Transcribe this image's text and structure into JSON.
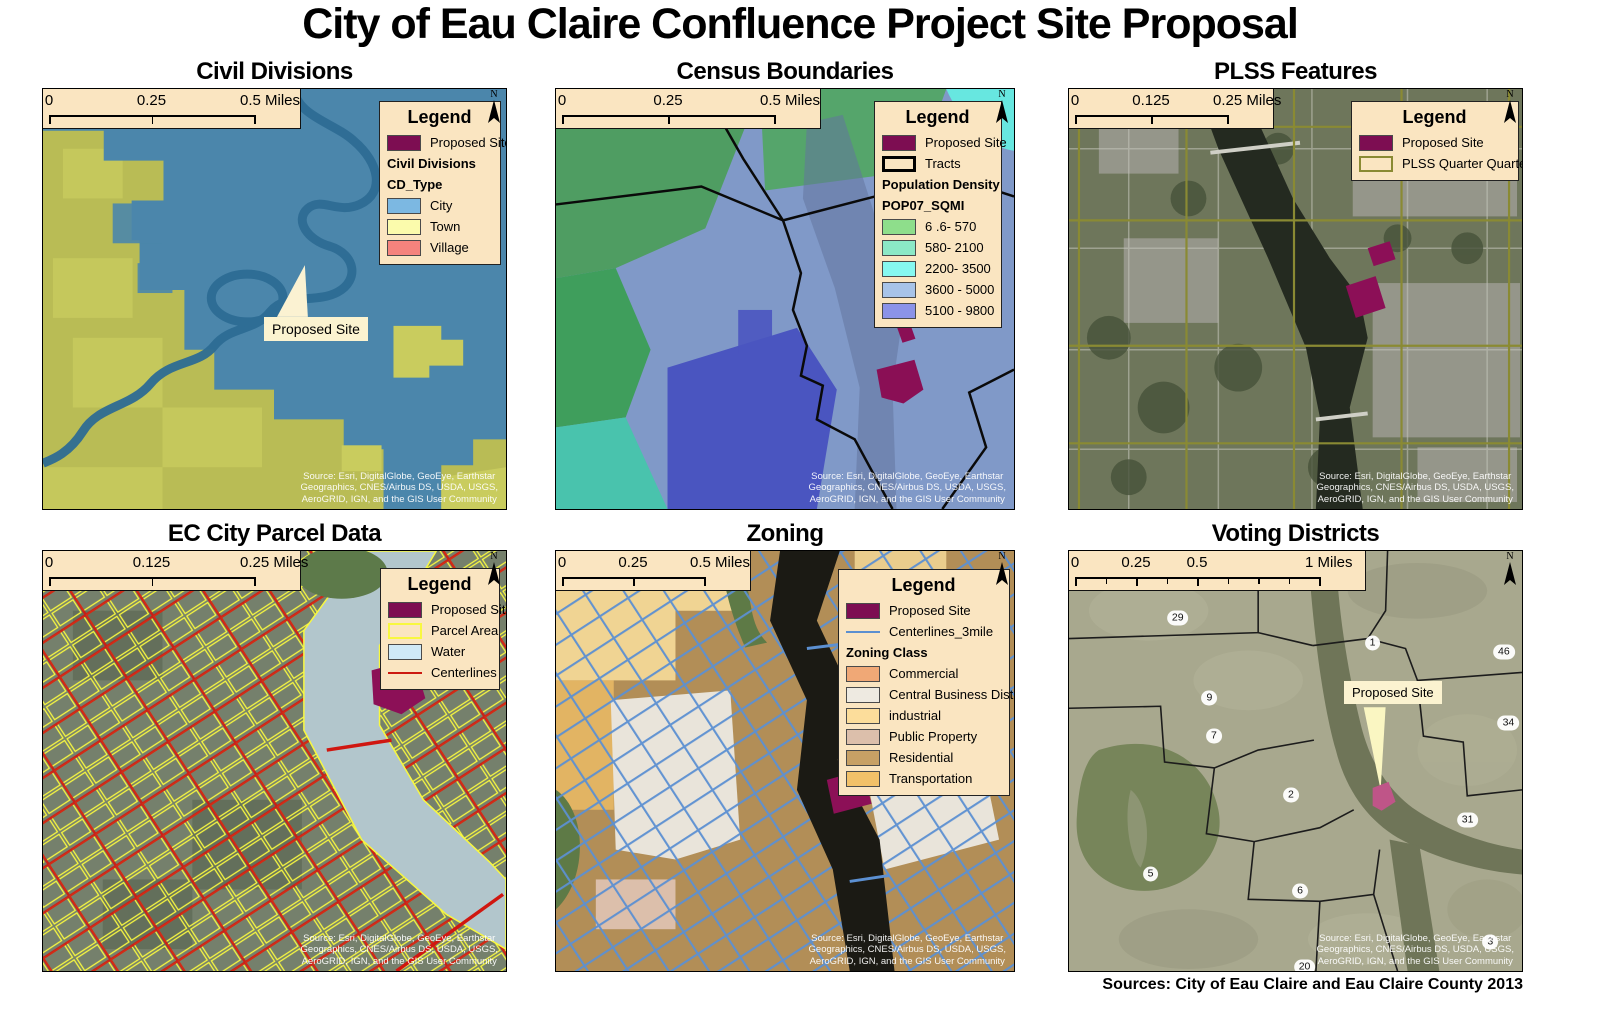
{
  "page": {
    "title": "City of Eau Claire Confluence Project Site Proposal",
    "caption": "Sources: City of Eau Claire and Eau Claire County 2013"
  },
  "shared": {
    "legend_title": "Legend",
    "north_label": "N",
    "source_lines": [
      "Source: Esri, DigitalGlobe, GeoEye, Earthstar",
      "Geographics, CNES/Airbus DS, USDA, USGS,",
      "AeroGRID, IGN, and the GIS User Community"
    ],
    "colors": {
      "proposed_site": "#7d0d52",
      "box_background": "#fae5c1"
    }
  },
  "panels": [
    {
      "title": "Civil Divisions",
      "scalebar": {
        "ticks": [
          "0",
          "0.25",
          "0.5 Miles"
        ]
      },
      "callout": "Proposed Site",
      "legend": {
        "items": [
          {
            "label": "Proposed Site",
            "type": "fill",
            "swatch": "#7d0d52"
          },
          {
            "label": "Civil Divisions",
            "type": "heading"
          },
          {
            "label": "CD_Type",
            "type": "heading"
          },
          {
            "label": "City",
            "type": "fill",
            "swatch": "#7cb8e2"
          },
          {
            "label": "Town",
            "type": "fill",
            "swatch": "#fbfbac"
          },
          {
            "label": "Village",
            "type": "fill",
            "swatch": "#f4837d"
          }
        ]
      }
    },
    {
      "title": "Census Boundaries",
      "scalebar": {
        "ticks": [
          "0",
          "0.25",
          "0.5 Miles"
        ]
      },
      "legend": {
        "items": [
          {
            "label": "Proposed Site",
            "type": "fill",
            "swatch": "#7d0d52"
          },
          {
            "label": "Tracts",
            "type": "outline",
            "swatch": "#fae5c1",
            "border": "#000000"
          },
          {
            "label": "Population Density",
            "type": "heading"
          },
          {
            "label": "POP07_SQMI",
            "type": "heading"
          },
          {
            "label": "6 .6- 570",
            "type": "fill",
            "swatch": "#8ede8b"
          },
          {
            "label": "580- 2100",
            "type": "fill",
            "swatch": "#8be8c6"
          },
          {
            "label": "2200- 3500",
            "type": "fill",
            "swatch": "#86f8f0"
          },
          {
            "label": "3600 - 5000",
            "type": "fill",
            "swatch": "#a7c3e8"
          },
          {
            "label": "5100 - 9800",
            "type": "fill",
            "swatch": "#8b93e8"
          }
        ]
      }
    },
    {
      "title": "PLSS Features",
      "scalebar": {
        "ticks": [
          "0",
          "0.125",
          "0.25 Miles"
        ]
      },
      "legend": {
        "items": [
          {
            "label": "Proposed Site",
            "type": "fill",
            "swatch": "#7d0d52"
          },
          {
            "label": "PLSS Quarter Quarter",
            "type": "outline",
            "swatch": "#fae5c1",
            "border": "#8a8a33"
          }
        ]
      }
    },
    {
      "title": "EC City Parcel Data",
      "scalebar": {
        "ticks": [
          "0",
          "0.125",
          "0.25 Miles"
        ]
      },
      "legend": {
        "items": [
          {
            "label": "Proposed Site",
            "type": "fill",
            "swatch": "#7d0d52"
          },
          {
            "label": "Parcel Area",
            "type": "outline",
            "swatch": "#fae5c1",
            "border": "#f8f840"
          },
          {
            "label": "Water",
            "type": "fill",
            "swatch": "#cfe9f7"
          },
          {
            "label": "Centerlines",
            "type": "line",
            "swatch": "#cc1910"
          }
        ]
      }
    },
    {
      "title": "Zoning",
      "scalebar": {
        "ticks": [
          "0",
          "0.25",
          "0.5 Miles"
        ]
      },
      "legend": {
        "items": [
          {
            "label": "Proposed Site",
            "type": "fill",
            "swatch": "#7d0d52"
          },
          {
            "label": "Centerlines_3mile",
            "type": "line",
            "swatch": "#5b8fd0"
          },
          {
            "label": "Zoning Class",
            "type": "heading"
          },
          {
            "label": "Commercial",
            "type": "fill",
            "swatch": "#f0a876"
          },
          {
            "label": "Central Business District",
            "type": "fill",
            "swatch": "#eeeae1"
          },
          {
            "label": "industrial",
            "type": "fill",
            "swatch": "#fcdd9b"
          },
          {
            "label": "Public Property",
            "type": "fill",
            "swatch": "#dcbfab"
          },
          {
            "label": "Residential",
            "type": "fill",
            "swatch": "#c7a065"
          },
          {
            "label": "Transportation",
            "type": "fill",
            "swatch": "#f2c169"
          }
        ]
      }
    },
    {
      "title": "Voting Districts",
      "scalebar": {
        "ticks": [
          "0",
          "0.25",
          "0.5",
          "1 Miles"
        ],
        "minor_divisions": 8
      },
      "callout": "Proposed Site",
      "districts": [
        "29",
        "1",
        "46",
        "9",
        "34",
        "7",
        "2",
        "31",
        "5",
        "6",
        "3",
        "20"
      ]
    }
  ]
}
